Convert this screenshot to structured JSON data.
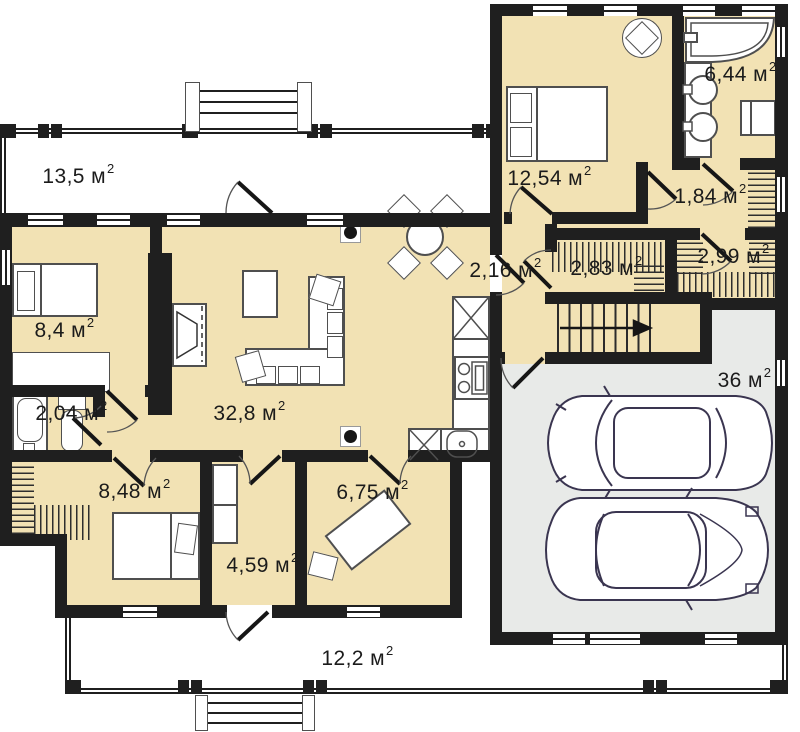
{
  "page": {
    "type": "house-floor-plan"
  },
  "sup_digit": "2",
  "rooms": {
    "terrace_top": {
      "label": "13,5 м"
    },
    "bedroom_top": {
      "label": "12,54 м"
    },
    "bathroom_top": {
      "label": "6,44 м"
    },
    "hall_wardrobe": {
      "label": "1,84 м"
    },
    "closet_right": {
      "label": "2,99 м"
    },
    "closet_left": {
      "label": "2,83 м"
    },
    "hall_stairs": {
      "label": "2,16 м"
    },
    "bedroom_left": {
      "label": "8,4 м"
    },
    "living": {
      "label": "32,8 м"
    },
    "garage": {
      "label": "36 м"
    },
    "bathroom_small": {
      "label": "2,04 м"
    },
    "bedroom_bottom": {
      "label": "8,48 м"
    },
    "office": {
      "label": "6,75 м"
    },
    "hall_bottom": {
      "label": "4,59 м"
    },
    "terrace_bottom": {
      "label": "12,2 м"
    }
  },
  "colors": {
    "wall": "#1f1f1f",
    "room_fill": "#f2e2b4",
    "garage_fill": "#e8eae8",
    "furniture_line": "#4f4f4f",
    "car_line": "#3a3550",
    "text": "#1b1b1b",
    "hatch": "#2e2e2e"
  }
}
